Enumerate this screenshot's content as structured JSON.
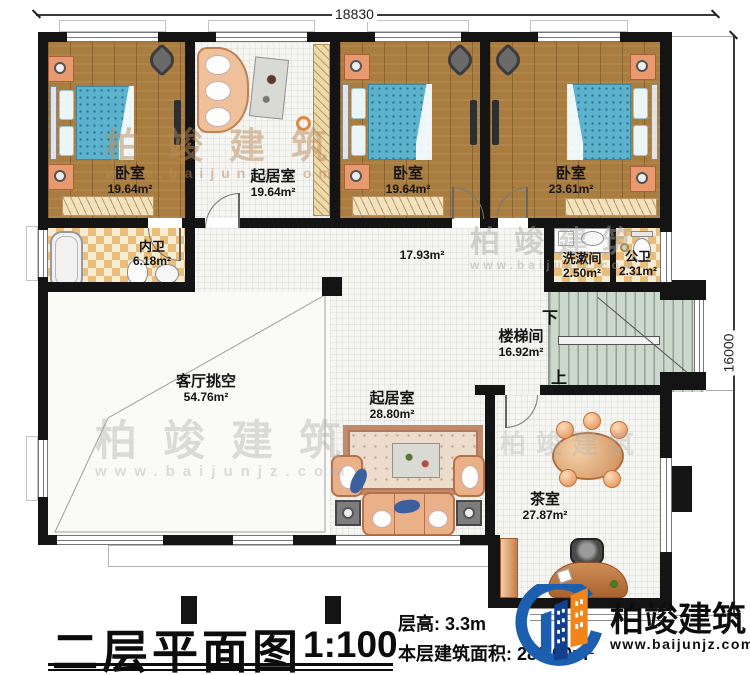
{
  "plan": {
    "title": "二层平面图",
    "scale": "1:100",
    "floor_height": "层高: 3.3m",
    "floor_area": "本层建筑面积: 289.00m²",
    "dim_top": "18830",
    "dim_right": "16000"
  },
  "rooms": {
    "bedroom1": {
      "label": "卧室",
      "area": "19.64m²"
    },
    "study": {
      "label": "起居室",
      "area": "19.64m²"
    },
    "bedroom2": {
      "label": "卧室",
      "area": "19.64m²"
    },
    "bedroom3": {
      "label": "卧室",
      "area": "23.61m²"
    },
    "inner_bath": {
      "label": "内卫",
      "area": "6.18m²"
    },
    "corridor": {
      "area": "17.93m²"
    },
    "washroom": {
      "label": "洗漱间",
      "area": "2.50m²"
    },
    "public_toilet": {
      "label": "公卫",
      "area": "2.31m²"
    },
    "stairwell": {
      "label": "楼梯间",
      "area": "16.92m²",
      "down": "下",
      "up": "上"
    },
    "void": {
      "label": "客厅挑空",
      "area": "54.76m²"
    },
    "living": {
      "label": "起居室",
      "area": "28.80m²"
    },
    "tea_room": {
      "label": "茶室",
      "area": "27.87m²"
    }
  },
  "logo": {
    "name": "柏竣建筑",
    "url": "www.baijunjz.com"
  },
  "watermark": {
    "text": "柏竣建筑",
    "url": "www.baijunjz.com"
  },
  "colors": {
    "wall": "#141414",
    "wood": "#a97c3f",
    "bed_blue": "#5db2cd",
    "stair_green": "#cdd8cd",
    "logo_blue": "#1b5fae",
    "logo_orange": "#f08519"
  }
}
